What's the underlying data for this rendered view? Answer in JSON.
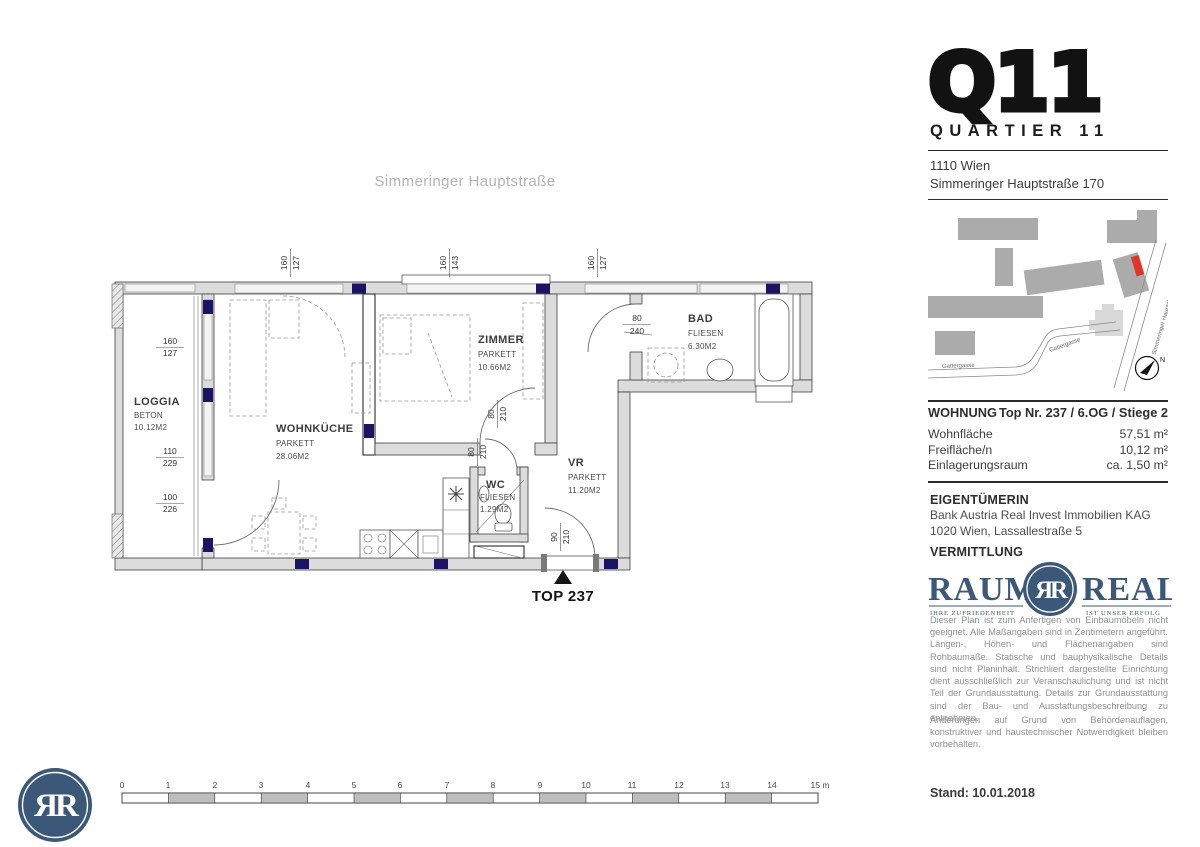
{
  "plan": {
    "street_label": "Simmeringer Hauptstraße",
    "entry_label": "TOP 237",
    "rooms": {
      "loggia": {
        "name": "LOGGIA",
        "material": "BETON",
        "area": "10.12M2"
      },
      "wohnkueche": {
        "name": "WOHNKÜCHE",
        "material": "PARKETT",
        "area": "28.06M2"
      },
      "zimmer": {
        "name": "ZIMMER",
        "material": "PARKETT",
        "area": "10.66M2"
      },
      "bad": {
        "name": "BAD",
        "material": "FLIESEN",
        "area": "6.30M2"
      },
      "vr": {
        "name": "VR",
        "material": "PARKETT",
        "area": "11.20M2"
      },
      "wc": {
        "name": "WC",
        "material": "FLIESEN",
        "area": "1.29M2"
      }
    },
    "dims": {
      "win_top_left": {
        "a": "160",
        "b": "127"
      },
      "win_top_mid": {
        "a": "160",
        "b": "143"
      },
      "win_top_right": {
        "a": "160",
        "b": "127"
      },
      "loggia_win": {
        "a": "160",
        "b": "127"
      },
      "loggia_door": {
        "a": "110",
        "b": "229"
      },
      "loggia_win2": {
        "a": "100",
        "b": "226"
      },
      "zimmer_door": {
        "a": "80",
        "b": "210"
      },
      "wc_door": {
        "a": "80",
        "b": "210"
      },
      "bad_door": {
        "a": "80",
        "b": "240"
      },
      "entry_door": {
        "a": "90",
        "b": "210"
      }
    }
  },
  "sidebar": {
    "project": {
      "logo": "Q11",
      "subtitle": "QUARTIER 11"
    },
    "address": {
      "line1": "1110 Wien",
      "line2": "Simmeringer Hauptstraße 170"
    },
    "map": {
      "street1": "Gattergasse",
      "street2": "Gattergasse",
      "street3": "Simmeringer Hauptstraße",
      "north": "N"
    },
    "unit": {
      "heading": "WOHNUNG",
      "unit_no": "Top Nr. 237 / 6.OG / Stiege 2",
      "rows": [
        {
          "label": "Wohnfläche",
          "value": "57,51 m²"
        },
        {
          "label": "Freifläche/n",
          "value": "10,12 m²"
        },
        {
          "label": "Einlagerungsraum",
          "value": "ca. 1,50 m²"
        }
      ]
    },
    "owner": {
      "heading": "EIGENTÜMERIN",
      "line1": "Bank Austria Real Invest Immobilien KAG",
      "line2": "1020 Wien, Lassallestraße 5"
    },
    "broker": {
      "heading": "VERMITTLUNG",
      "brand_left": "RAUM",
      "brand_monogram": "ЯR",
      "brand_right": "REAL",
      "tagline_left": "IHRE ZUFRIEDENHEIT",
      "tagline_right": "IST UNSER ERFOLG"
    },
    "disclaimer": {
      "p1": "Dieser Plan ist zum Anfertigen von Einbaumöbeln nicht geeignet. Alle Maßangaben sind in Zentimetern angeführt. Längen-, Höhen- und Flächenangaben sind Rohbaumaße. Statische und bauphysikalische Details sind nicht Planinhalt. Strichliert dargestellte Einrichtung dient ausschließlich zur Veranschaulichung und ist nicht Teil der Grundausstattung. Details zur Grundausstattung sind der Bau- und Ausstattungsbeschreibung zu entnehmen.",
      "p2": "Änderungen auf Grund von Behördenauflagen, konstruktiver und haustechnischer Notwendigkeit bleiben vorbehalten."
    },
    "date_label": "Stand: 10.01.2018"
  },
  "scalebar": {
    "ticks": [
      "0",
      "1",
      "2",
      "3",
      "4",
      "5",
      "6",
      "7",
      "8",
      "9",
      "10",
      "11",
      "12",
      "13",
      "14",
      "15 m"
    ]
  },
  "footer": {
    "monogram": "ЯR"
  },
  "colors": {
    "brand_navy": "#3b5878",
    "map_highlight_red": "#e23326",
    "window_marker_navy": "#1b1464",
    "wall_gray": "#dcdcdc",
    "building_gray": "#ababab"
  }
}
